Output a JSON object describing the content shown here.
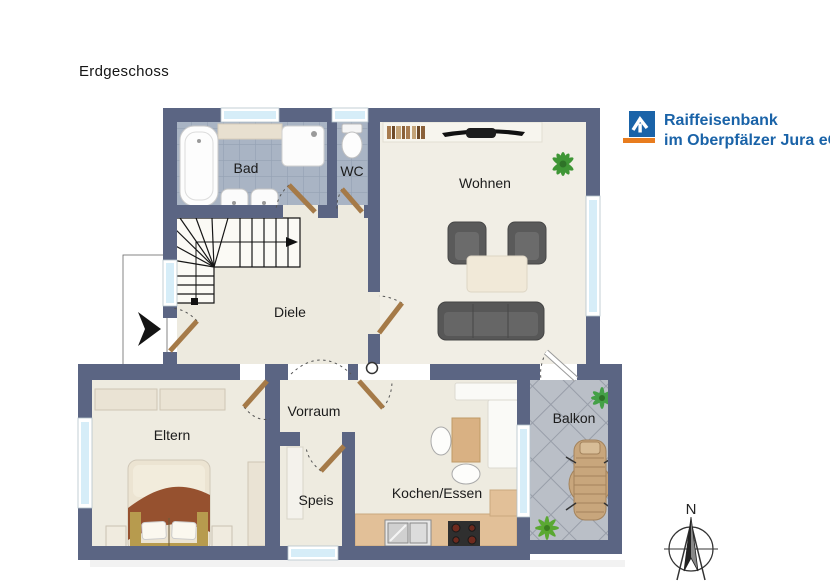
{
  "title": "Erdgeschoss",
  "logo": {
    "line1": "Raiffeisenbank",
    "line2": "im Oberpfälzer Jura eG",
    "text_color": "#1a63a8",
    "mark_blue": "#1a63a8",
    "mark_orange": "#e87c1e"
  },
  "floorplan": {
    "rooms": [
      {
        "id": "bad",
        "label": "Bad"
      },
      {
        "id": "wc",
        "label": "WC"
      },
      {
        "id": "wohnen",
        "label": "Wohnen"
      },
      {
        "id": "diele",
        "label": "Diele"
      },
      {
        "id": "eltern",
        "label": "Eltern"
      },
      {
        "id": "vorraum",
        "label": "Vorraum"
      },
      {
        "id": "speis",
        "label": "Speis"
      },
      {
        "id": "kochen_essen",
        "label": "Kochen/Essen"
      },
      {
        "id": "balkon",
        "label": "Balkon"
      }
    ],
    "colors": {
      "wall": "#5b6583",
      "floor": "#efece1",
      "bath_tile": "#a9b4c4",
      "balcony_tile": "#babfc7",
      "window_glass": "#d6edf8",
      "kitchen_counter": "#e2c098",
      "door_leaf": "#a57a48",
      "plant_green": "#3f9636"
    }
  },
  "compass": {
    "north_label": "N"
  }
}
